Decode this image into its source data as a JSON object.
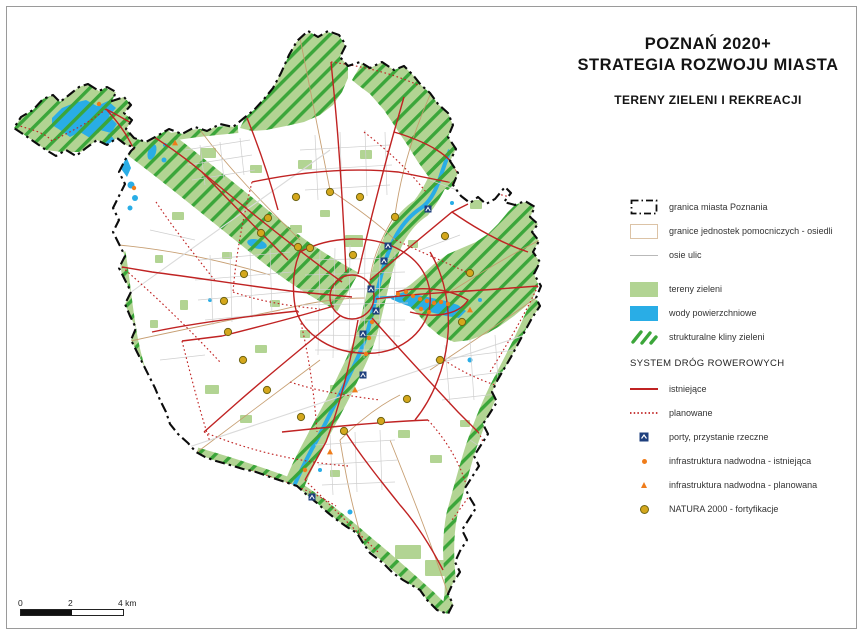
{
  "title": {
    "line1": "POZNAŃ 2020+",
    "line2": "STRATEGIA ROZWOJU MIASTA",
    "subtitle": "TERENY ZIELENI I REKREACJI"
  },
  "legend": {
    "items": [
      {
        "type": "city-boundary",
        "label": "granica miasta Poznania"
      },
      {
        "type": "district-boundary",
        "label": "granice jednostek pomocniczych - osiedli"
      },
      {
        "type": "street-axes",
        "label": "osie ulic"
      },
      {
        "type": "green-areas",
        "label": "tereny zieleni"
      },
      {
        "type": "surface-waters",
        "label": "wody powierzchniowe"
      },
      {
        "type": "green-wedges",
        "label": "strukturalne kliny zieleni"
      },
      {
        "type": "section-header",
        "label": "SYSTEM DRÓG ROWEROWYCH"
      },
      {
        "type": "bike-existing",
        "label": "istniejące"
      },
      {
        "type": "bike-planned",
        "label": "planowane"
      },
      {
        "type": "river-ports",
        "label": "porty, przystanie rzeczne"
      },
      {
        "type": "waterside-existing",
        "label": "infrastruktura nadwodna - istniejąca"
      },
      {
        "type": "waterside-planned",
        "label": "infrastruktura nadwodna - planowana"
      },
      {
        "type": "natura-forts",
        "label": "NATURA 2000 - fortyfikacje"
      }
    ]
  },
  "scale_bar": {
    "labels": [
      "0",
      "2",
      "4 km"
    ]
  },
  "colors": {
    "green_area": "#b2d493",
    "wedge_hatch_green": "#3ba63a",
    "water_blue": "#29ade6",
    "bike_route_red": "#c02323",
    "district_boundary_tan": "#c49a6c",
    "street_gray": "#cfcfcf",
    "city_boundary_black": "#0c0c0c",
    "fort_yellow": "#d4a71c",
    "infra_orange": "#ef7c1a",
    "port_navy": "#1e3f7d"
  },
  "map_markers": {
    "natura_forts": [
      [
        268,
        218
      ],
      [
        296,
        197
      ],
      [
        330,
        192
      ],
      [
        360,
        197
      ],
      [
        395,
        217
      ],
      [
        445,
        236
      ],
      [
        470,
        273
      ],
      [
        462,
        322
      ],
      [
        440,
        360
      ],
      [
        407,
        399
      ],
      [
        381,
        421
      ],
      [
        344,
        431
      ],
      [
        301,
        417
      ],
      [
        267,
        390
      ],
      [
        243,
        360
      ],
      [
        228,
        332
      ],
      [
        224,
        301
      ],
      [
        244,
        274
      ],
      [
        261,
        233
      ],
      [
        298,
        247
      ],
      [
        310,
        248
      ],
      [
        353,
        255
      ]
    ],
    "river_ports": [
      [
        428,
        209
      ],
      [
        388,
        246
      ],
      [
        384,
        261
      ],
      [
        371,
        289
      ],
      [
        376,
        311
      ],
      [
        363,
        334
      ],
      [
        363,
        375
      ],
      [
        312,
        497
      ]
    ],
    "waterside_existing": [
      [
        99,
        104
      ],
      [
        134,
        188
      ],
      [
        398,
        294
      ],
      [
        406,
        292
      ],
      [
        413,
        296
      ],
      [
        420,
        299
      ],
      [
        427,
        301
      ],
      [
        434,
        303
      ],
      [
        441,
        302
      ],
      [
        448,
        304
      ],
      [
        421,
        309
      ],
      [
        429,
        312
      ],
      [
        372,
        322
      ],
      [
        369,
        338
      ],
      [
        366,
        354
      ],
      [
        305,
        470
      ]
    ],
    "waterside_planned": [
      [
        175,
        143
      ],
      [
        355,
        390
      ],
      [
        330,
        452
      ],
      [
        470,
        310
      ]
    ]
  }
}
